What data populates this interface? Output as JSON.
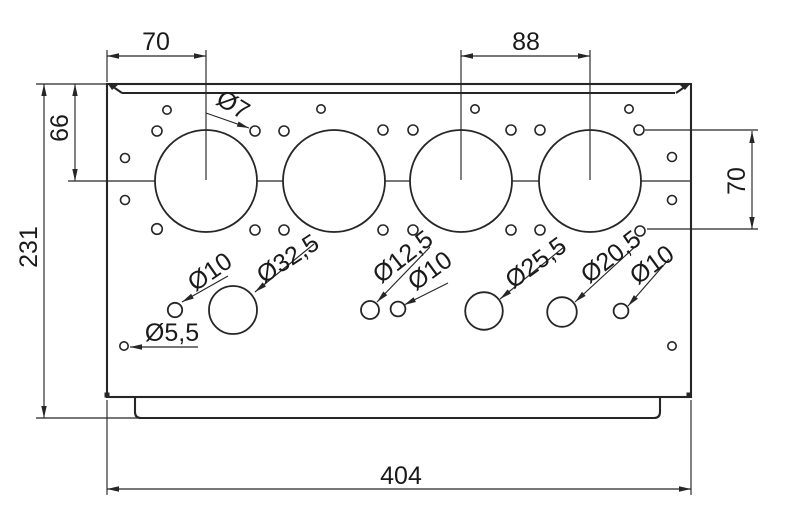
{
  "drawing": {
    "canvas": {
      "width": 800,
      "height": 526,
      "background": "#ffffff",
      "stroke": "#262626",
      "text_color": "#1a1a1a"
    },
    "plate": {
      "outline": {
        "x": 107,
        "y": 84,
        "width": 584,
        "height": 313
      },
      "top_inner_edge": {
        "x1": 122,
        "y1": 93,
        "x2": 675,
        "y2": 93
      },
      "chamfers": [
        {
          "name": "top-left-chamfer",
          "line": [
            109,
            84,
            122,
            93
          ],
          "notch": "108,84 119,84 112,90"
        },
        {
          "name": "top-right-chamfer",
          "line": [
            689,
            84,
            676,
            93
          ],
          "notch": "679,84 690,84 685,90"
        }
      ],
      "corner_ticks": [
        {
          "x": 107,
          "y": 395
        },
        {
          "x": 689,
          "y": 395
        }
      ],
      "lip": {
        "x1": 135,
        "x2": 660,
        "y_top": 397,
        "y_bottom": 418,
        "corner_radius": 6
      }
    },
    "bores": {
      "centers_x": [
        206,
        334,
        461,
        590
      ],
      "center_y": 181,
      "radius": 51
    },
    "center_line_segments": [
      [
        68,
        155
      ],
      [
        257,
        283
      ],
      [
        385,
        410
      ],
      [
        512,
        539
      ],
      [
        641,
        691
      ]
    ],
    "center_line_y": 181,
    "holes": [
      {
        "x": 167,
        "y": 110,
        "r": 4.2
      },
      {
        "x": 321,
        "y": 109,
        "r": 4.2
      },
      {
        "x": 475,
        "y": 109,
        "r": 4.2
      },
      {
        "x": 629,
        "y": 109,
        "r": 4.2
      },
      {
        "x": 157,
        "y": 131,
        "r": 5
      },
      {
        "x": 255,
        "y": 131,
        "r": 5
      },
      {
        "x": 284,
        "y": 131,
        "r": 5
      },
      {
        "x": 383,
        "y": 130,
        "r": 5
      },
      {
        "x": 413,
        "y": 130,
        "r": 5
      },
      {
        "x": 511,
        "y": 130,
        "r": 5
      },
      {
        "x": 540,
        "y": 130,
        "r": 5
      },
      {
        "x": 639,
        "y": 130,
        "r": 5
      },
      {
        "x": 125,
        "y": 158,
        "r": 4.5
      },
      {
        "x": 125,
        "y": 200,
        "r": 4.5
      },
      {
        "x": 672,
        "y": 157,
        "r": 4.5
      },
      {
        "x": 672,
        "y": 200,
        "r": 4.5
      },
      {
        "x": 157,
        "y": 229,
        "r": 5.3
      },
      {
        "x": 255,
        "y": 230,
        "r": 5
      },
      {
        "x": 284,
        "y": 230,
        "r": 5
      },
      {
        "x": 383,
        "y": 230,
        "r": 5
      },
      {
        "x": 413,
        "y": 230,
        "r": 5
      },
      {
        "x": 511,
        "y": 230,
        "r": 5
      },
      {
        "x": 540,
        "y": 230,
        "r": 5
      },
      {
        "x": 640,
        "y": 231,
        "r": 5
      },
      {
        "x": 175,
        "y": 310,
        "r": 7.2
      },
      {
        "x": 233,
        "y": 310,
        "r": 24
      },
      {
        "x": 370,
        "y": 310,
        "r": 9
      },
      {
        "x": 398,
        "y": 309,
        "r": 7.4
      },
      {
        "x": 484,
        "y": 311,
        "r": 18.8
      },
      {
        "x": 562,
        "y": 312,
        "r": 14.8
      },
      {
        "x": 621,
        "y": 311,
        "r": 7.4
      },
      {
        "x": 124,
        "y": 346,
        "r": 4.2
      },
      {
        "x": 672,
        "y": 346,
        "r": 4.2
      }
    ],
    "dimensions": [
      {
        "label": "70",
        "name": "dim-70-top-left",
        "text": {
          "x": 156,
          "y": 42,
          "rotate": 0
        },
        "line": [
          107,
          56,
          206,
          56
        ],
        "arrows": [
          {
            "x": 107,
            "y": 56,
            "angle": 180
          },
          {
            "x": 206,
            "y": 56,
            "angle": 0
          }
        ],
        "ext": [
          [
            107,
            50,
            107,
            82
          ],
          [
            206,
            50,
            206,
            180
          ]
        ]
      },
      {
        "label": "88",
        "name": "dim-88-top",
        "text": {
          "x": 526,
          "y": 42,
          "rotate": 0
        },
        "line": [
          461,
          56,
          590,
          56
        ],
        "arrows": [
          {
            "x": 461,
            "y": 56,
            "angle": 180
          },
          {
            "x": 590,
            "y": 56,
            "angle": 0
          }
        ],
        "ext": [
          [
            461,
            50,
            461,
            180
          ],
          [
            590,
            50,
            590,
            180
          ]
        ]
      },
      {
        "label": "66",
        "name": "dim-66-left",
        "text": {
          "x": 60,
          "y": 128,
          "rotate": -90
        },
        "line": [
          75,
          84,
          75,
          181
        ],
        "arrows": [
          {
            "x": 75,
            "y": 84,
            "angle": -90
          },
          {
            "x": 75,
            "y": 181,
            "angle": 90
          }
        ],
        "ext": [
          [
            36,
            84,
            107,
            84
          ]
        ]
      },
      {
        "label": "231",
        "name": "dim-231-left",
        "text": {
          "x": 29,
          "y": 247,
          "rotate": -90
        },
        "line": [
          44,
          84,
          44,
          418
        ],
        "arrows": [
          {
            "x": 44,
            "y": 84,
            "angle": -90
          },
          {
            "x": 44,
            "y": 418,
            "angle": 90
          }
        ],
        "ext": [
          [
            36,
            418,
            141,
            418
          ]
        ]
      },
      {
        "label": "70",
        "name": "dim-70-right",
        "text": {
          "x": 737,
          "y": 181,
          "rotate": -90
        },
        "line": [
          752,
          131,
          752,
          229
        ],
        "arrows": [
          {
            "x": 752,
            "y": 131,
            "angle": -90
          },
          {
            "x": 752,
            "y": 229,
            "angle": 90
          }
        ],
        "ext": [
          [
            645,
            130,
            758,
            130
          ],
          [
            647,
            229,
            758,
            229
          ]
        ]
      },
      {
        "label": "404",
        "name": "dim-404-bottom",
        "text": {
          "x": 401,
          "y": 476,
          "rotate": 0
        },
        "line": [
          107,
          489,
          691,
          489
        ],
        "arrows": [
          {
            "x": 107,
            "y": 489,
            "angle": 180
          },
          {
            "x": 691,
            "y": 489,
            "angle": 0
          }
        ],
        "ext": [
          [
            107,
            400,
            107,
            495
          ],
          [
            691,
            400,
            691,
            495
          ]
        ]
      }
    ],
    "leaders": [
      {
        "label": "Ø7",
        "name": "leader-dia-7",
        "text": {
          "x": 233,
          "y": 105,
          "rotate": 31
        },
        "line": [
          206,
          113,
          249,
          128
        ]
      },
      {
        "label": "Ø10",
        "name": "leader-dia-10-a",
        "text": {
          "x": 210,
          "y": 272,
          "rotate": -35
        },
        "line": [
          228,
          276,
          182,
          302
        ]
      },
      {
        "label": "Ø32,5",
        "name": "leader-dia-32-5",
        "text": {
          "x": 288,
          "y": 259,
          "rotate": -33
        },
        "line": [
          314,
          244,
          255,
          292
        ]
      },
      {
        "label": "Ø5,5",
        "name": "leader-dia-5-5",
        "text": {
          "x": 172,
          "y": 333,
          "rotate": 0
        },
        "line": [
          198,
          347,
          130,
          347
        ]
      },
      {
        "label": "Ø12,5",
        "name": "leader-dia-12-5",
        "text": {
          "x": 403,
          "y": 257,
          "rotate": -38
        },
        "line": [
          430,
          247,
          377,
          302
        ]
      },
      {
        "label": "Ø10",
        "name": "leader-dia-10-b",
        "text": {
          "x": 430,
          "y": 271,
          "rotate": -36
        },
        "line": [
          448,
          283,
          404,
          305
        ]
      },
      {
        "label": "Ø25,5",
        "name": "leader-dia-25-5",
        "text": {
          "x": 536,
          "y": 263,
          "rotate": -36
        },
        "line": [
          564,
          247,
          500,
          299
        ]
      },
      {
        "label": "Ø20,5",
        "name": "leader-dia-20-5",
        "text": {
          "x": 611,
          "y": 257,
          "rotate": -38
        },
        "line": [
          638,
          244,
          575,
          302
        ]
      },
      {
        "label": "Ø10",
        "name": "leader-dia-10-c",
        "text": {
          "x": 652,
          "y": 265,
          "rotate": -36
        },
        "line": [
          669,
          259,
          628,
          306
        ]
      }
    ]
  }
}
